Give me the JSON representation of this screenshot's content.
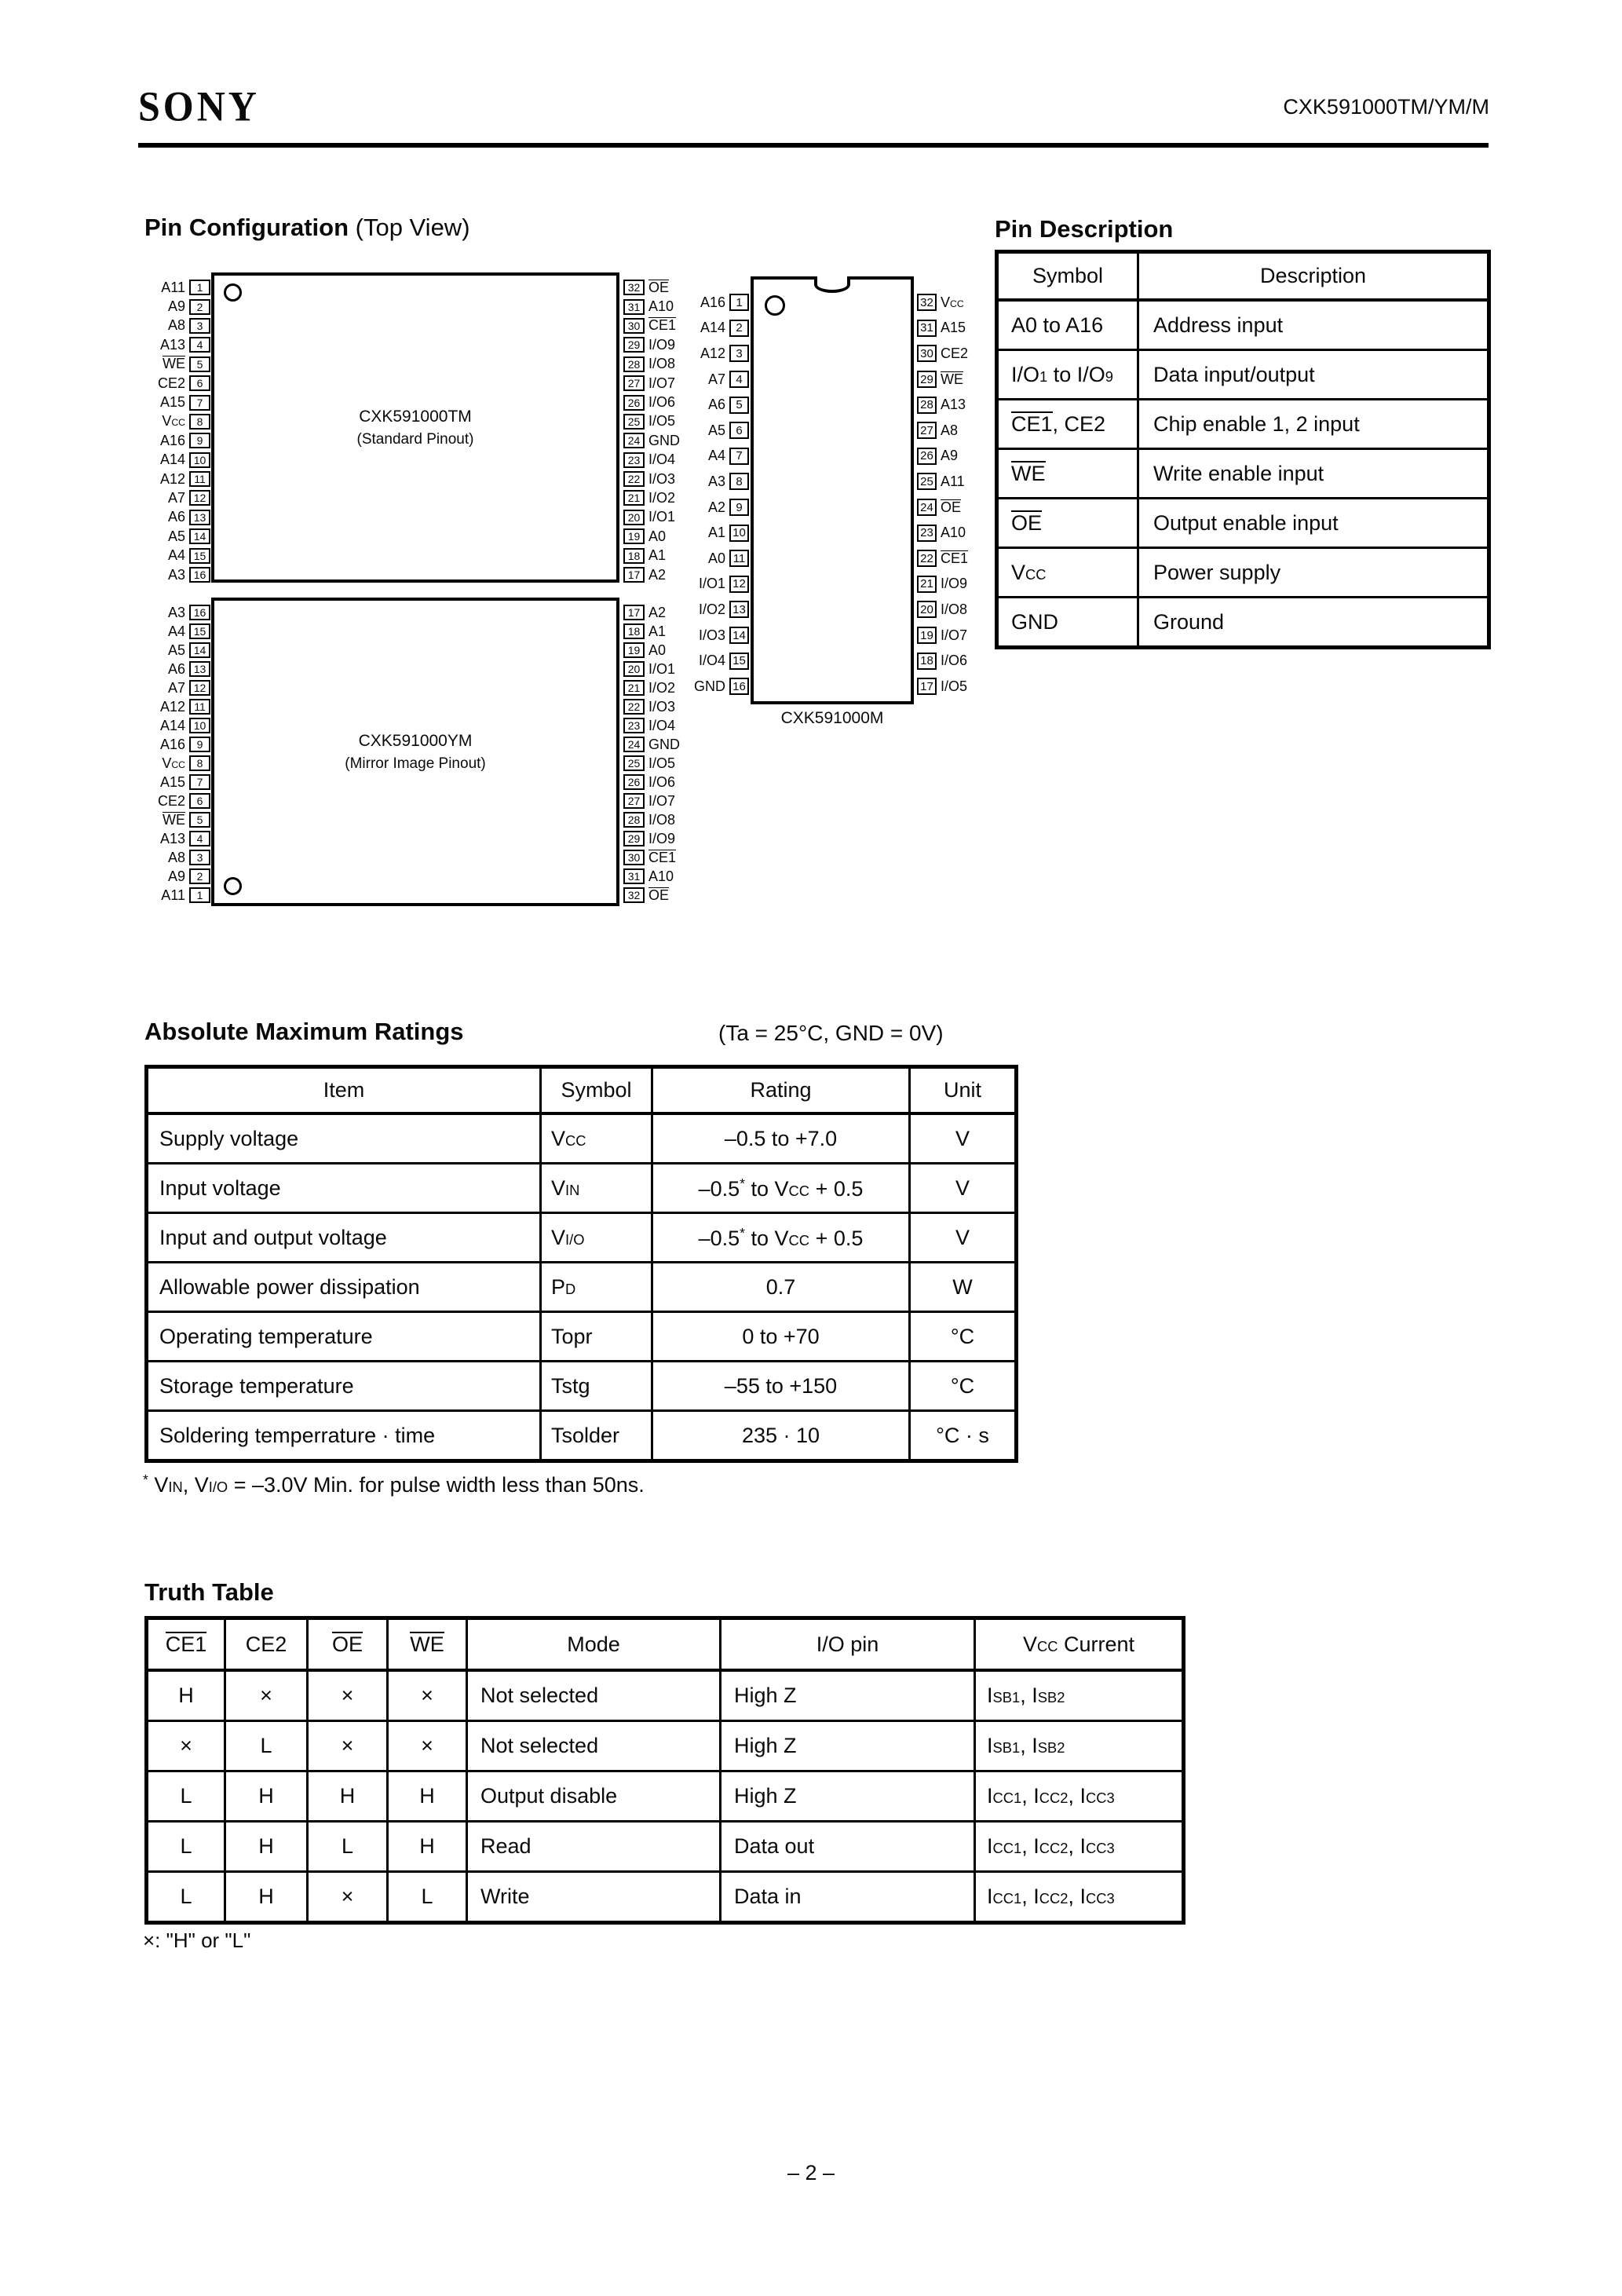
{
  "header": {
    "brand": "SONY",
    "doc_number": "CXK591000TM/YM/M"
  },
  "pin_configuration": {
    "heading": "Pin Configuration",
    "heading_suffix": " (Top View)",
    "chips": {
      "tm": {
        "name": "CXK591000TM",
        "pinout": "(Standard Pinout)",
        "left": [
          {
            "label": "A11",
            "num": "1"
          },
          {
            "label": "A9",
            "num": "2"
          },
          {
            "label": "A8",
            "num": "3"
          },
          {
            "label": "A13",
            "num": "4"
          },
          {
            "label": "{b:WE}",
            "num": "5"
          },
          {
            "label": "CE2",
            "num": "6"
          },
          {
            "label": "A15",
            "num": "7"
          },
          {
            "label": "V{s:CC}",
            "num": "8"
          },
          {
            "label": "A16",
            "num": "9"
          },
          {
            "label": "A14",
            "num": "10"
          },
          {
            "label": "A12",
            "num": "11"
          },
          {
            "label": "A7",
            "num": "12"
          },
          {
            "label": "A6",
            "num": "13"
          },
          {
            "label": "A5",
            "num": "14"
          },
          {
            "label": "A4",
            "num": "15"
          },
          {
            "label": "A3",
            "num": "16"
          }
        ],
        "right": [
          {
            "num": "32",
            "label": "{b:OE}"
          },
          {
            "num": "31",
            "label": "A10"
          },
          {
            "num": "30",
            "label": "{b:CE1}"
          },
          {
            "num": "29",
            "label": "I/O9"
          },
          {
            "num": "28",
            "label": "I/O8"
          },
          {
            "num": "27",
            "label": "I/O7"
          },
          {
            "num": "26",
            "label": "I/O6"
          },
          {
            "num": "25",
            "label": "I/O5"
          },
          {
            "num": "24",
            "label": "GND"
          },
          {
            "num": "23",
            "label": "I/O4"
          },
          {
            "num": "22",
            "label": "I/O3"
          },
          {
            "num": "21",
            "label": "I/O2"
          },
          {
            "num": "20",
            "label": "I/O1"
          },
          {
            "num": "19",
            "label": "A0"
          },
          {
            "num": "18",
            "label": "A1"
          },
          {
            "num": "17",
            "label": "A2"
          }
        ]
      },
      "ym": {
        "name": "CXK591000YM",
        "pinout": "(Mirror Image Pinout)",
        "left": [
          {
            "label": "A3",
            "num": "16"
          },
          {
            "label": "A4",
            "num": "15"
          },
          {
            "label": "A5",
            "num": "14"
          },
          {
            "label": "A6",
            "num": "13"
          },
          {
            "label": "A7",
            "num": "12"
          },
          {
            "label": "A12",
            "num": "11"
          },
          {
            "label": "A14",
            "num": "10"
          },
          {
            "label": "A16",
            "num": "9"
          },
          {
            "label": "V{s:CC}",
            "num": "8"
          },
          {
            "label": "A15",
            "num": "7"
          },
          {
            "label": "CE2",
            "num": "6"
          },
          {
            "label": "{b:WE}",
            "num": "5"
          },
          {
            "label": "A13",
            "num": "4"
          },
          {
            "label": "A8",
            "num": "3"
          },
          {
            "label": "A9",
            "num": "2"
          },
          {
            "label": "A11",
            "num": "1"
          }
        ],
        "right": [
          {
            "num": "17",
            "label": "A2"
          },
          {
            "num": "18",
            "label": "A1"
          },
          {
            "num": "19",
            "label": "A0"
          },
          {
            "num": "20",
            "label": "I/O1"
          },
          {
            "num": "21",
            "label": "I/O2"
          },
          {
            "num": "22",
            "label": "I/O3"
          },
          {
            "num": "23",
            "label": "I/O4"
          },
          {
            "num": "24",
            "label": "GND"
          },
          {
            "num": "25",
            "label": "I/O5"
          },
          {
            "num": "26",
            "label": "I/O6"
          },
          {
            "num": "27",
            "label": "I/O7"
          },
          {
            "num": "28",
            "label": "I/O8"
          },
          {
            "num": "29",
            "label": "I/O9"
          },
          {
            "num": "30",
            "label": "{b:CE1}"
          },
          {
            "num": "31",
            "label": "A10"
          },
          {
            "num": "32",
            "label": "{b:OE}"
          }
        ]
      },
      "m": {
        "name": "CXK591000M",
        "left": [
          {
            "label": "A16",
            "num": "1"
          },
          {
            "label": "A14",
            "num": "2"
          },
          {
            "label": "A12",
            "num": "3"
          },
          {
            "label": "A7",
            "num": "4"
          },
          {
            "label": "A6",
            "num": "5"
          },
          {
            "label": "A5",
            "num": "6"
          },
          {
            "label": "A4",
            "num": "7"
          },
          {
            "label": "A3",
            "num": "8"
          },
          {
            "label": "A2",
            "num": "9"
          },
          {
            "label": "A1",
            "num": "10"
          },
          {
            "label": "A0",
            "num": "11"
          },
          {
            "label": "I/O1",
            "num": "12"
          },
          {
            "label": "I/O2",
            "num": "13"
          },
          {
            "label": "I/O3",
            "num": "14"
          },
          {
            "label": "I/O4",
            "num": "15"
          },
          {
            "label": "GND",
            "num": "16"
          }
        ],
        "right": [
          {
            "num": "32",
            "label": "V{s:CC}"
          },
          {
            "num": "31",
            "label": "A15"
          },
          {
            "num": "30",
            "label": "CE2"
          },
          {
            "num": "29",
            "label": "{b:WE}"
          },
          {
            "num": "28",
            "label": "A13"
          },
          {
            "num": "27",
            "label": "A8"
          },
          {
            "num": "26",
            "label": "A9"
          },
          {
            "num": "25",
            "label": "A11"
          },
          {
            "num": "24",
            "label": "{b:OE}"
          },
          {
            "num": "23",
            "label": "A10"
          },
          {
            "num": "22",
            "label": "{b:CE1}"
          },
          {
            "num": "21",
            "label": "I/O9"
          },
          {
            "num": "20",
            "label": "I/O8"
          },
          {
            "num": "19",
            "label": "I/O7"
          },
          {
            "num": "18",
            "label": "I/O6"
          },
          {
            "num": "17",
            "label": "I/O5"
          }
        ]
      }
    }
  },
  "pin_description": {
    "heading": "Pin Description",
    "headers": [
      "Symbol",
      "Description"
    ],
    "rows": [
      [
        "A0 to A16",
        "Address input"
      ],
      [
        "I/O{s:1} to I/O{s:9}",
        "Data input/output"
      ],
      [
        "{b:CE1}, CE2",
        "Chip enable 1, 2 input"
      ],
      [
        "{b:WE}",
        "Write enable input"
      ],
      [
        "{b:OE}",
        "Output enable input"
      ],
      [
        "V{s:CC}",
        "Power supply"
      ],
      [
        "GND",
        "Ground"
      ]
    ]
  },
  "absolute_maximum_ratings": {
    "heading": "Absolute Maximum Ratings",
    "condition": "(Ta = 25°C, GND = 0V)",
    "headers": [
      "Item",
      "Symbol",
      "Rating",
      "Unit"
    ],
    "rows": [
      [
        "Supply voltage",
        "V{s:CC}",
        "–0.5 to +7.0",
        "V"
      ],
      [
        "Input voltage",
        "V{s:IN}",
        "–0.5{u:*} to V{s:CC} + 0.5",
        "V"
      ],
      [
        "Input and output voltage",
        "V{s:I/O}",
        "–0.5{u:*} to V{s:CC} + 0.5",
        "V"
      ],
      [
        "Allowable power dissipation",
        "P{s:D}",
        "0.7",
        "W"
      ],
      [
        "Operating temperature",
        "Topr",
        "0 to +70",
        "°C"
      ],
      [
        "Storage temperature",
        "Tstg",
        "–55 to +150",
        "°C"
      ],
      [
        "Soldering temperrature · time",
        "Tsolder",
        "235 · 10",
        "°C · s"
      ]
    ],
    "note": "{u:*} V{s:IN}, V{s:I/O} = –3.0V Min. for pulse width less than 50ns."
  },
  "truth_table": {
    "heading": "Truth Table",
    "headers": [
      "{b:CE1}",
      "CE2",
      "{b:OE}",
      "{b:WE}",
      "Mode",
      "I/O pin",
      "V{s:CC} Current"
    ],
    "rows": [
      [
        "H",
        "×",
        "×",
        "×",
        "Not selected",
        "High Z",
        "I{s:SB1}, I{s:SB2}"
      ],
      [
        "×",
        "L",
        "×",
        "×",
        "Not selected",
        "High Z",
        "I{s:SB1}, I{s:SB2}"
      ],
      [
        "L",
        "H",
        "H",
        "H",
        "Output disable",
        "High Z",
        "I{s:CC1}, I{s:CC2}, I{s:CC3}"
      ],
      [
        "L",
        "H",
        "L",
        "H",
        "Read",
        "Data out",
        "I{s:CC1}, I{s:CC2}, I{s:CC3}"
      ],
      [
        "L",
        "H",
        "×",
        "L",
        "Write",
        "Data in",
        "I{s:CC1}, I{s:CC2}, I{s:CC3}"
      ]
    ],
    "note": "×: \"H\" or \"L\""
  },
  "footer": {
    "page_number": "– 2 –"
  }
}
